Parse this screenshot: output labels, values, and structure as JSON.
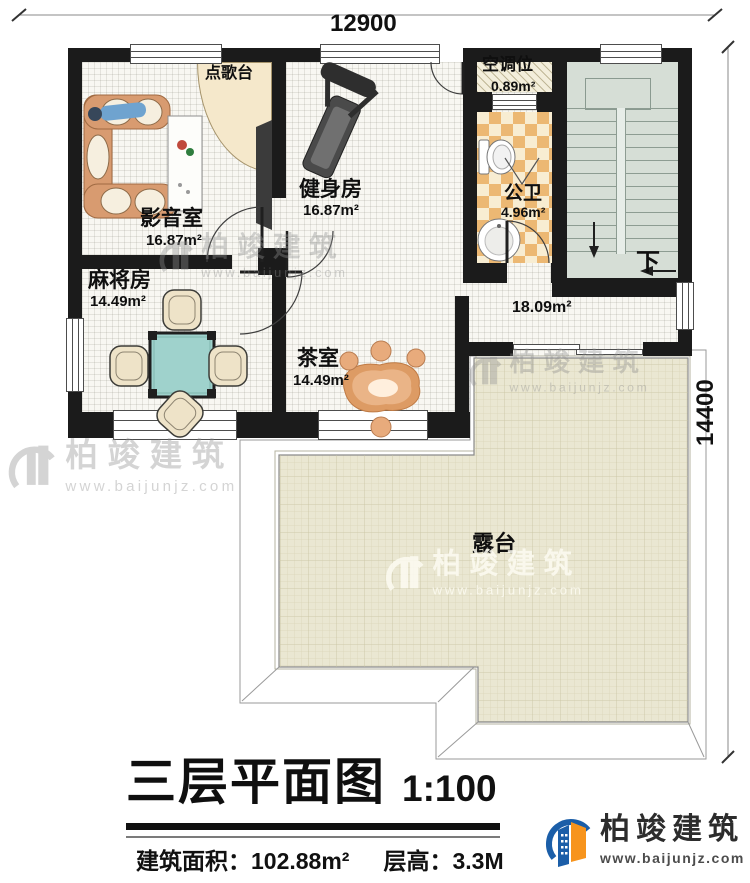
{
  "dimensions": {
    "top": "12900",
    "right": "14400"
  },
  "rooms": {
    "media": {
      "name": "影音室",
      "area": "16.87m²"
    },
    "gym": {
      "name": "健身房",
      "area": "16.87m²"
    },
    "mahjong": {
      "name": "麻将房",
      "area": "14.49m²"
    },
    "tea": {
      "name": "茶室",
      "area": "14.49m²"
    },
    "bath": {
      "name": "公卫",
      "area": "4.96m²"
    },
    "ac": {
      "name": "空调位",
      "area": "0.89m²"
    },
    "hall": {
      "area": "18.09m²"
    },
    "terrace": {
      "name": "露台"
    },
    "karaoke": {
      "name": "点歌台"
    },
    "stairs": {
      "direction": "下"
    }
  },
  "title": {
    "main": "三层平面图",
    "scale": "1:100"
  },
  "info": {
    "area_label": "建筑面积：",
    "area_value": "102.88m²",
    "height_label": "层高：",
    "height_value": "3.3M"
  },
  "brand": {
    "name": "柏竣建筑",
    "website": "www.baijunjz.com"
  },
  "watermark": {
    "name": "柏竣建筑",
    "website": "www.baijunjz.com"
  },
  "colors": {
    "wall": "#1b1b1b",
    "stair_floor": "#d6ded6",
    "bath_tile_dark": "#ecb873",
    "bath_tile_light": "#f8edd2",
    "terrace_floor": "#eae7d2",
    "karaoke_floor": "#f5e8cb",
    "mahjong_table": "#9fd2cc",
    "tea_table": "#dd9b64",
    "sofa": "#d89b70",
    "logo_blue": "#1b5ea8",
    "logo_orange": "#f7941d"
  }
}
